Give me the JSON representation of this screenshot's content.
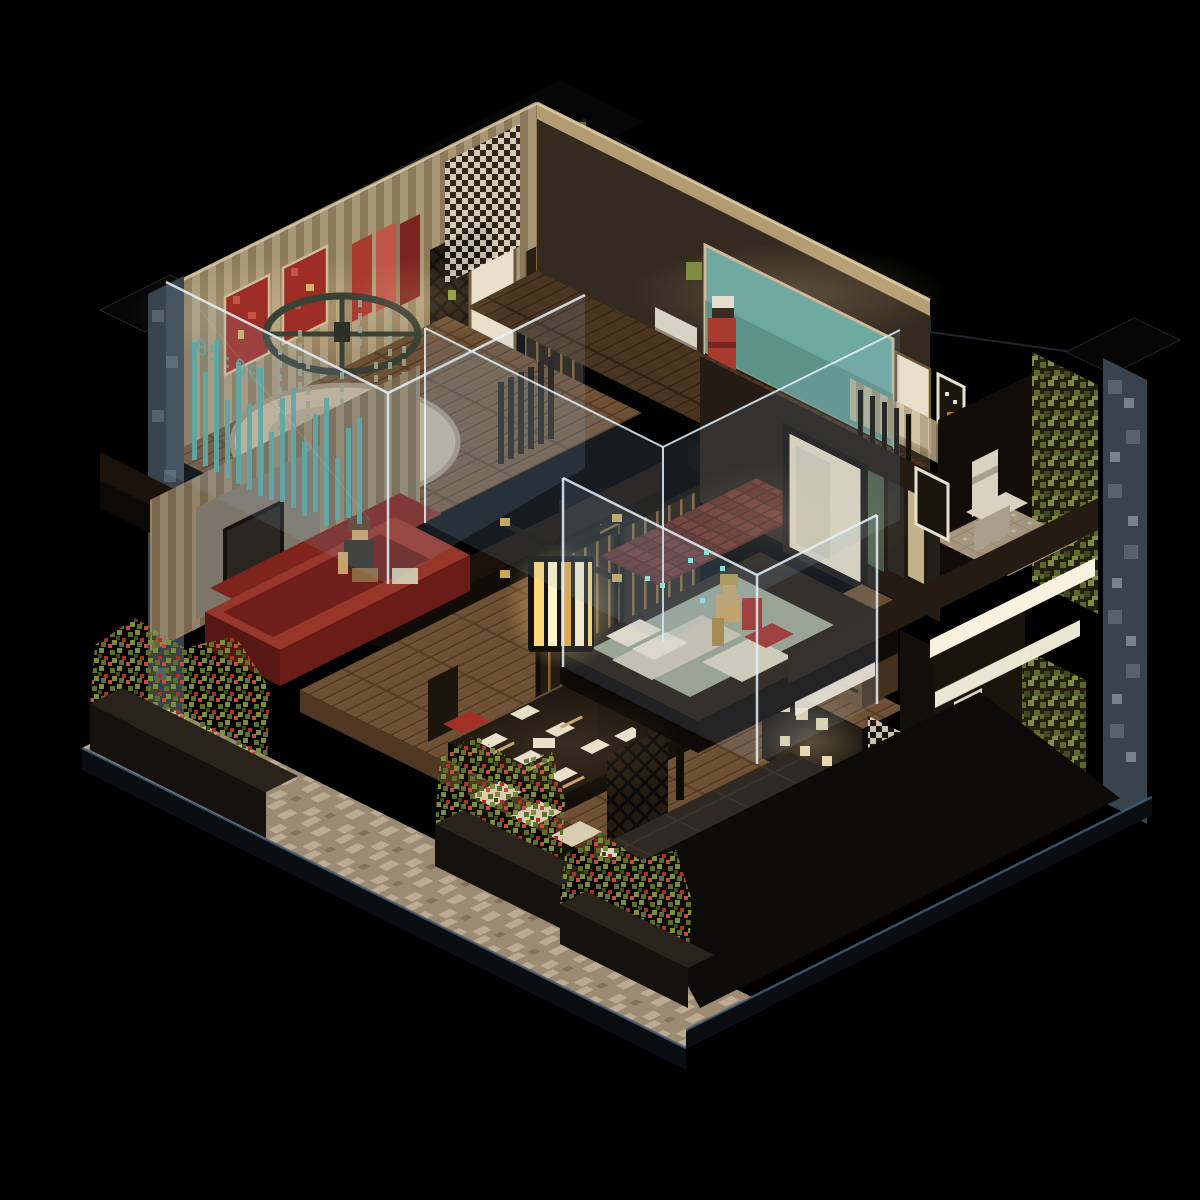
{
  "scene": {
    "type": "voxel-isometric-interior-diorama",
    "style": "japanese-apartment-cutaway-night",
    "background": "#000000",
    "clock_display": "05:00"
  },
  "palette": {
    "bg": "#000000",
    "roofEdge": "#20262d",
    "stripeA": "#cdbb97",
    "stripeB": "#a79370",
    "trimWood": "#b39b72",
    "trimLit": "#e8d5a8",
    "wallDark": "#342a1f",
    "wallDarker": "#1b140d",
    "wallGrey": "#7d7568",
    "doorWhite": "#e9e0cb",
    "doorFrame": "#6b5638",
    "slatDoor": "#241a10",
    "slatGlint": "#c89a55",
    "teal": "#6fa89f",
    "tealDark": "#4e8077",
    "artRed": "#9e2d25",
    "artRedLight": "#c0564a",
    "robeRed": "#a93a30",
    "robeDark": "#7c241f",
    "ivy": "#5c682f",
    "ivyLight": "#7d8c41",
    "ivyDark": "#3f4a20",
    "stone": "#55616d",
    "stoneLight": "#76838f",
    "stoneDark": "#39434c",
    "deck": "#6e5034",
    "deckLight": "#84613f",
    "deckDark": "#4f3722",
    "slab": "#1a120b",
    "slabFace": "#0d0906",
    "rug": "#c5b296",
    "rugShade": "#a28f74",
    "fan": "#3a4034",
    "bead": "#9aa38d",
    "glassFill": "rgba(150,180,205,0.15)",
    "glassEdge": "rgba(228,242,252,0.85)",
    "clockTeal": "#55a7a2",
    "tealSpark": "#8fe0d8",
    "sofaRed": "#7e241d",
    "sofaRedLight": "#97362b",
    "skin": "#c9a169",
    "skinYellow": "#caa15a",
    "hair": "#5f3f28",
    "clothDark": "#35302a",
    "tableDark": "#20170f",
    "cushion": "#d9cdb1",
    "cushionRed": "#a22f26",
    "dish": "#e7dfcc",
    "chop": "#c3a06b",
    "latticeBase": "#241b12",
    "islandRed": "#7c2a21",
    "islandFrame": "#191310",
    "counter": "#3a322a",
    "counterDark": "#23201b",
    "trayBlack": "#0c0b0a",
    "trayRim": "#e8e2d2",
    "tileK": "#2e2923",
    "groutK": "#3c362e",
    "tileBath": "#a5957e",
    "tileBathLight": "#c2b299",
    "toilet": "#d9d2c2",
    "toiletShade": "#a89f8e",
    "bedBase": "#241a11",
    "mattress": "#9aa18b",
    "pillow": "#e8dfc9",
    "blanket": "#d8cfb8",
    "bedRed": "#a03028",
    "dresser": "#6b4e31",
    "dresserDark": "#43301d",
    "mirror": "#ded5bf",
    "frameDark": "#17120d",
    "brickRed": "#6e3128",
    "brickDark": "#4a2019",
    "led": "#f7f1de",
    "lanternGlow": "#ffd978",
    "lanternDeep": "#e8a93e",
    "lanternFrame": "#14100b",
    "planterBox": "#15110d",
    "planterRim": "#2a231c",
    "plantG": "#5f6d2f",
    "plantG2": "#7d8c3e",
    "flowerR": "#a93227",
    "flowerR2": "#c44c38",
    "patio": "#9d8a72",
    "patioLight": "#bdab91",
    "patioDark": "#6f6050",
    "baseRim": "#47617c",
    "baseDark": "#0a0d11",
    "glowWarm": "#ffe6ae",
    "checkA": "#ded6c4",
    "checkB": "#1c1610",
    "sculpt": "#ddd6c6"
  },
  "rooms": [
    {
      "id": "loft-bedroom",
      "label": "Loft room with round rug and red wall art"
    },
    {
      "id": "upper-hallway",
      "label": "Upper hallway with white door and slatted doors"
    },
    {
      "id": "study",
      "label": "Study with teal aquarium wall and standing figure"
    },
    {
      "id": "upper-bathroom",
      "label": "Upper bathroom with toilet and ivy wall"
    },
    {
      "id": "bedroom",
      "label": "Bedroom with platform bed and glass enclosure"
    },
    {
      "id": "lower-bathroom",
      "label": "Lower bathroom with toilet and patterned tile"
    },
    {
      "id": "kitchen",
      "label": "Kitchen with red cabinets and lit shelves"
    },
    {
      "id": "dining-area",
      "label": "Dining area with long table and lantern"
    },
    {
      "id": "lounge",
      "label": "Lounge with red daybed and seated figure"
    },
    {
      "id": "patio",
      "label": "Front patio walkway with planter boxes"
    }
  ],
  "objects": [
    "round-rug",
    "ceiling-fan-chandelier",
    "waterfall-clock",
    "red-artworks",
    "hanging-robes",
    "wardrobe",
    "white-door",
    "slatted-door",
    "teal-wall-panel",
    "standing-figure-red",
    "printer",
    "glass-partitions",
    "pendant-lantern",
    "shoji-screens",
    "dining-table",
    "dining-chairs",
    "dishes",
    "lattice-screen",
    "white-sculpture",
    "kitchen-island-red",
    "counter-tray",
    "flower-pot",
    "platform-bed",
    "seated-figure-bed",
    "dresser",
    "mirror-panel",
    "hanging-clothes",
    "toilet-upper",
    "toilet-lower",
    "ivy-walls",
    "led-strips",
    "stone-pillars",
    "red-daybed",
    "seated-figure-lounge",
    "planter-boxes",
    "patio-tiles"
  ]
}
